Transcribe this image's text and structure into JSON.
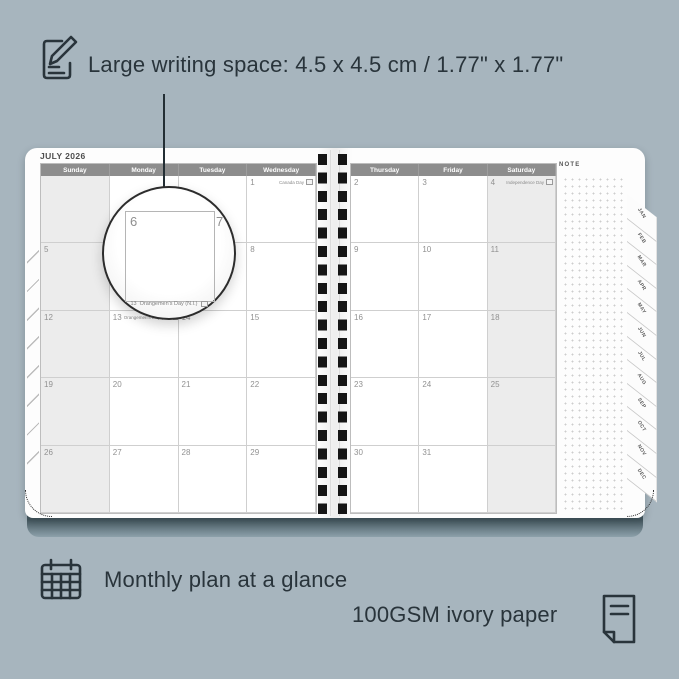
{
  "annotations": {
    "top": {
      "icon": "pencil-note-icon",
      "text": "Large writing space: 4.5 x 4.5 cm / 1.77\" x 1.77\""
    },
    "bottom_left": {
      "icon": "calendar-grid-icon",
      "text": "Monthly plan at a glance"
    },
    "bottom_right": {
      "icon": "paper-sheet-icon",
      "text": "100GSM ivory paper"
    }
  },
  "planner": {
    "title": "JULY 2026",
    "note_label": "NOTE",
    "left_days": [
      "Sunday",
      "Monday",
      "Tuesday",
      "Wednesday"
    ],
    "right_days": [
      "Thursday",
      "Friday",
      "Saturday"
    ],
    "tabs": [
      "JAN",
      "FEB",
      "MAR",
      "APR",
      "MAY",
      "JUN",
      "JUL",
      "AUG",
      "SEP",
      "OCT",
      "NOV",
      "DEC"
    ],
    "left_cells": [
      {
        "date": "",
        "holiday": ""
      },
      {
        "date": "",
        "holiday": ""
      },
      {
        "date": "",
        "holiday": ""
      },
      {
        "date": "1",
        "holiday": "Canada Day"
      },
      {
        "date": "5"
      },
      {
        "date": "6"
      },
      {
        "date": "7"
      },
      {
        "date": "8"
      },
      {
        "date": "12"
      },
      {
        "date": "13",
        "holiday": "Orangemen's Day (N.I.)"
      },
      {
        "date": "14"
      },
      {
        "date": "15"
      },
      {
        "date": "19"
      },
      {
        "date": "20"
      },
      {
        "date": "21"
      },
      {
        "date": "22"
      },
      {
        "date": "26"
      },
      {
        "date": "27"
      },
      {
        "date": "28"
      },
      {
        "date": "29"
      }
    ],
    "right_cells": [
      {
        "date": "2"
      },
      {
        "date": "3"
      },
      {
        "date": "4",
        "holiday": "Independence Day"
      },
      {
        "date": "9"
      },
      {
        "date": "10"
      },
      {
        "date": "11"
      },
      {
        "date": "16"
      },
      {
        "date": "17"
      },
      {
        "date": "18"
      },
      {
        "date": "23"
      },
      {
        "date": "24"
      },
      {
        "date": "25"
      },
      {
        "date": "30"
      },
      {
        "date": "31"
      },
      {
        "date": ""
      }
    ],
    "magnifier": {
      "date": "6",
      "adjacent_date": "7",
      "below_date": "13",
      "holiday": "Orangemen's Day (N.I.)"
    }
  },
  "colors": {
    "background": "#a7b5be",
    "ink": "#29343b",
    "header_bar": "#8d8d8d",
    "weekend_shade": "#ececec",
    "spiral": "#151515",
    "cover_edge": "#44565e"
  }
}
